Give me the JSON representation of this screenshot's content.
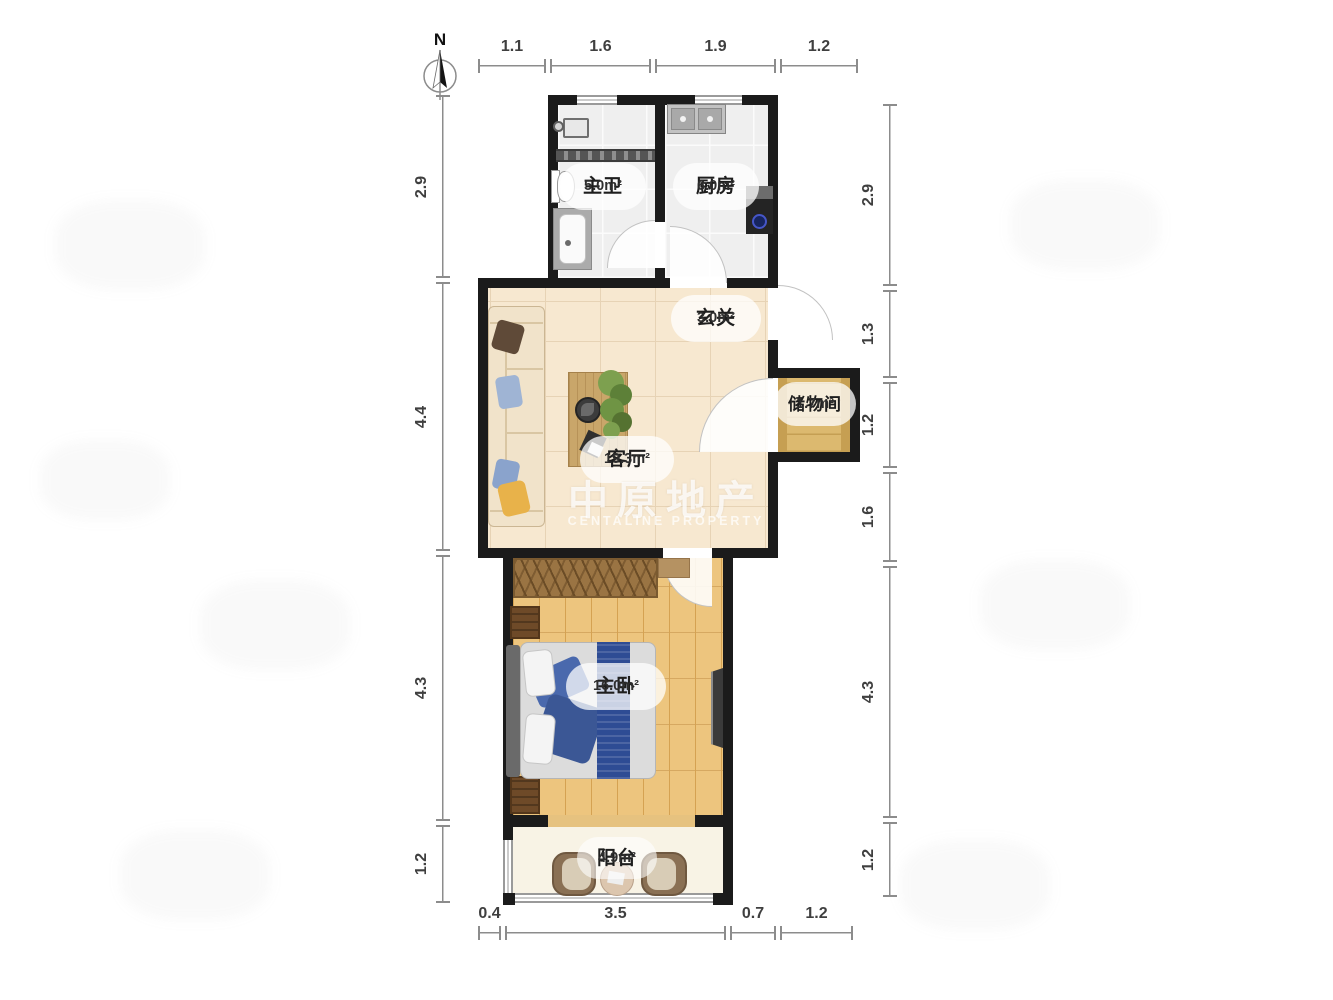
{
  "compass": {
    "north_label": "N"
  },
  "rooms": {
    "bathroom": {
      "name": "主卫",
      "area": "5.0m²"
    },
    "kitchen": {
      "name": "厨房",
      "area": "6.0m²"
    },
    "hallway": {
      "name": "玄关",
      "area": "3.0m²"
    },
    "storage": {
      "name": "储物间",
      "area": "1.7m²"
    },
    "living": {
      "name": "客厅",
      "area": "19.3m²"
    },
    "bedroom": {
      "name": "主卧",
      "area": "16.0m²"
    },
    "balcony": {
      "name": "阳台",
      "area": "4.9m²"
    }
  },
  "dimensions": {
    "top": [
      "1.1",
      "1.6",
      "1.9",
      "1.2"
    ],
    "left": [
      "2.9",
      "4.4",
      "4.3",
      "1.2"
    ],
    "right": [
      "2.9",
      "1.3",
      "1.2",
      "1.6",
      "4.3",
      "1.2"
    ],
    "bottom": [
      "0.4",
      "3.5",
      "0.7",
      "1.2"
    ]
  },
  "watermark": {
    "title": "中原地产",
    "subtitle": "CENTALINE PROPERTY"
  },
  "colors": {
    "wall": "#1b1b1b",
    "living_floor": "#f7e8d0",
    "bedroom_floor": "#edc57e",
    "storage_floor": "#dcb96f",
    "tile_floor": "#efefef",
    "bed_runner_blue": "#2e4c94",
    "stove_blue": "#4656c8",
    "pillow_yellow": "#e8b24a",
    "dimension_grey": "#8c8c8c"
  }
}
